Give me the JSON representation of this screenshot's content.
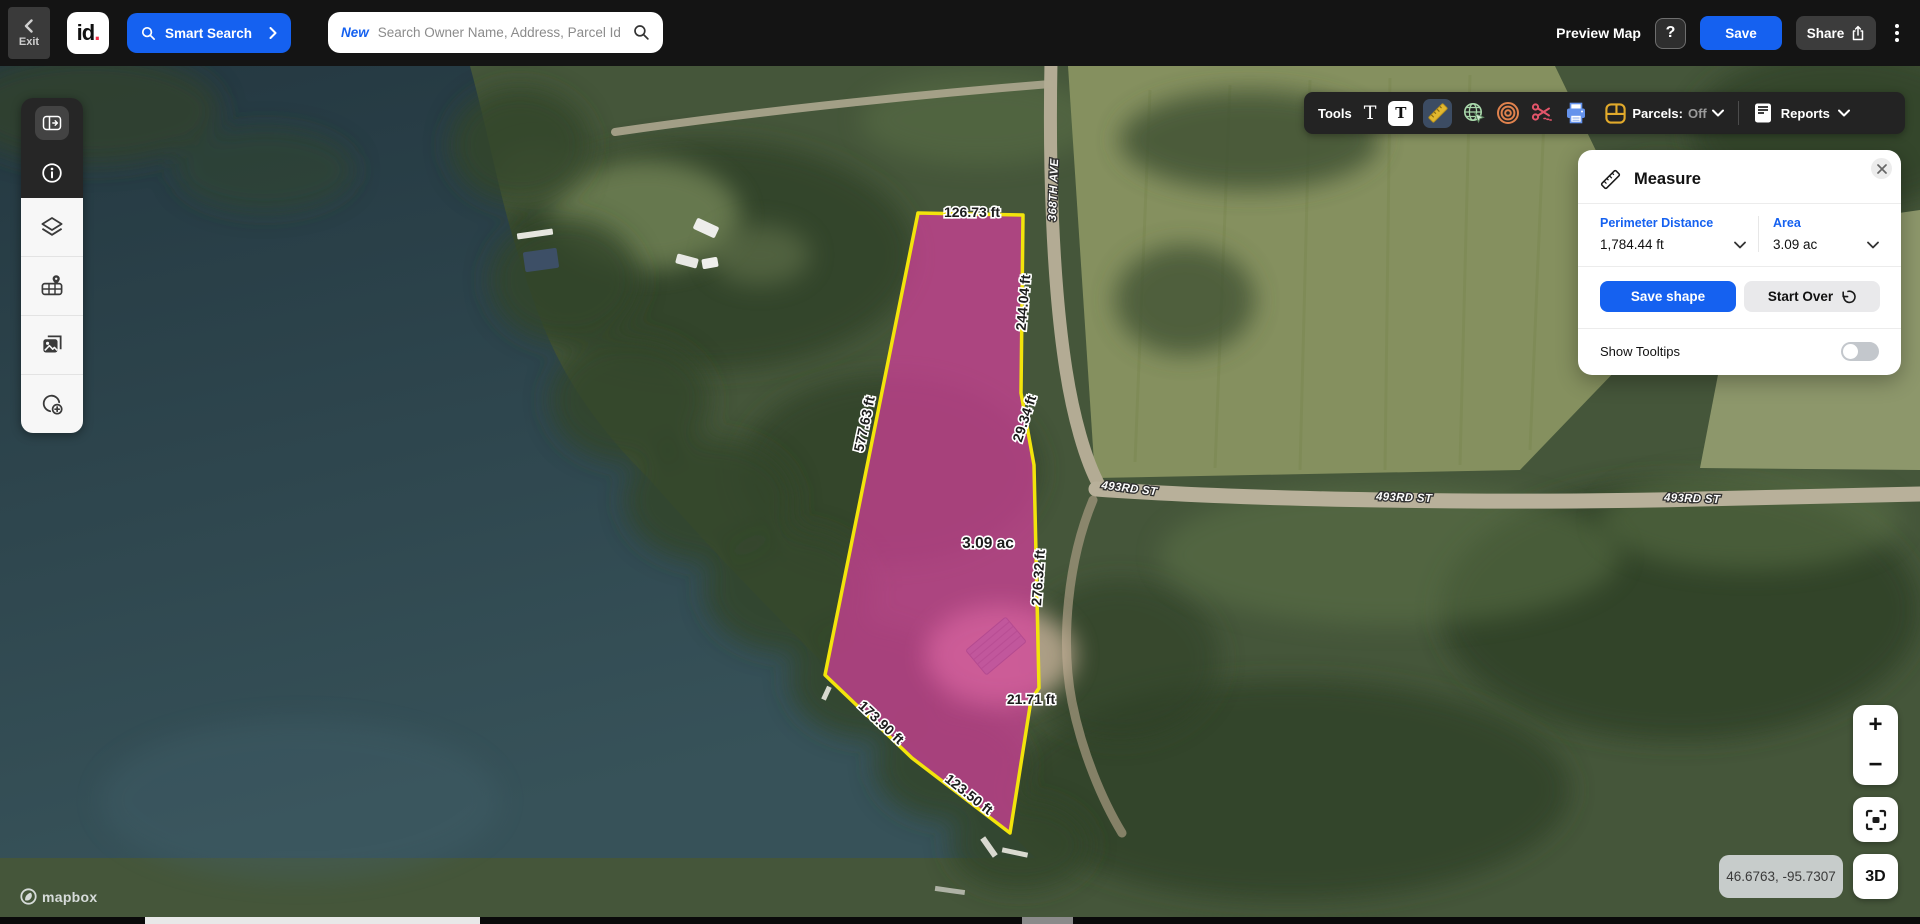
{
  "topbar": {
    "exit_label": "Exit",
    "logo_text": "id",
    "logo_dot": ".",
    "smart_search_label": "Smart Search",
    "search_badge": "New",
    "search_placeholder": "Search Owner Name, Address, Parcel Id",
    "preview_map_label": "Preview Map",
    "help_label": "?",
    "save_label": "Save",
    "share_label": "Share"
  },
  "toolbar": {
    "tools_label": "Tools",
    "text_icon": "T",
    "text_box_icon": "T",
    "parcels_label": "Parcels:",
    "parcels_state": "Off",
    "reports_label": "Reports"
  },
  "measure_panel": {
    "title": "Measure",
    "perimeter_label": "Perimeter Distance",
    "perimeter_value": "1,784.44 ft",
    "area_label": "Area",
    "area_value": "3.09 ac",
    "save_shape_label": "Save shape",
    "start_over_label": "Start Over",
    "show_tooltips_label": "Show Tooltips",
    "tooltips_enabled": false
  },
  "map": {
    "measurements": {
      "top": "126.73 ft",
      "right_upper": "244.04 ft",
      "right_bend": "29.34 ft",
      "left": "577.63 ft",
      "right_lower": "276.32 ft",
      "notch": "21.71 ft",
      "bottom_left": "173.90 ft",
      "bottom_right": "123.50 ft",
      "area": "3.09 ac"
    },
    "roads": {
      "avenue": "368TH AVE",
      "street_west": "493RD ST",
      "street_mid": "493RD ST",
      "street_east": "493RD ST"
    }
  },
  "map_controls": {
    "zoom_in": "+",
    "zoom_out": "−",
    "three_d_label": "3D",
    "coordinates": "46.6763, -95.7307"
  },
  "attribution": {
    "brand": "mapbox"
  },
  "colors": {
    "accent_blue": "#1561f0",
    "polygon_fill": "#d83f9e",
    "polygon_outline": "#f2e40c",
    "topbar_bg": "#141414",
    "toolbar_bg": "#232323"
  }
}
